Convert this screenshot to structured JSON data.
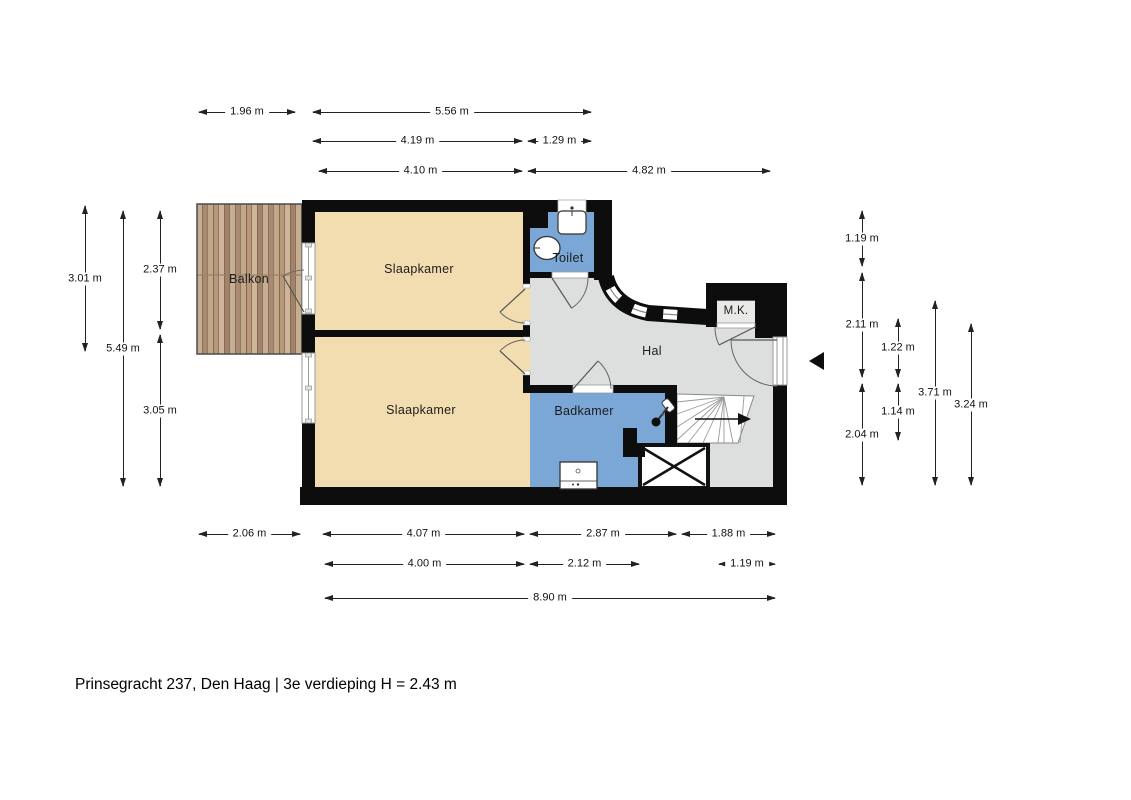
{
  "title": "Prinsegracht 237, Den Haag | 3e verdieping H = 2.43 m",
  "rooms": {
    "balkon": {
      "label": "Balkon"
    },
    "slaapkamer_top": {
      "label": "Slaapkamer"
    },
    "slaapkamer_bottom": {
      "label": "Slaapkamer"
    },
    "toilet": {
      "label": "Toilet"
    },
    "hal": {
      "label": "Hal"
    },
    "mk": {
      "label": "M.K."
    },
    "badkamer": {
      "label": "Badkamer"
    }
  },
  "dimensions": {
    "top": [
      "1.96 m",
      "5.56 m",
      "4.19 m",
      "1.29 m",
      "4.10 m",
      "4.82 m"
    ],
    "left": [
      "3.01 m",
      "5.49 m",
      "2.37 m",
      "3.05 m"
    ],
    "right": [
      "1.19 m",
      "2.11 m",
      "2.04 m",
      "1.22 m",
      "1.14 m",
      "3.71 m",
      "3.24 m"
    ],
    "bottom": [
      "2.06 m",
      "4.07 m",
      "2.87 m",
      "1.88 m",
      "4.00 m",
      "2.12 m",
      "1.19 m",
      "8.90 m"
    ]
  },
  "colors": {
    "bedroom": "#f2ddb0",
    "wet_room": "#7ba7d7",
    "hall": "#dcdfdd",
    "wall": "#0d0d0d",
    "wood_light": "#c7ad92",
    "wood_dark": "#8a6f5a"
  }
}
